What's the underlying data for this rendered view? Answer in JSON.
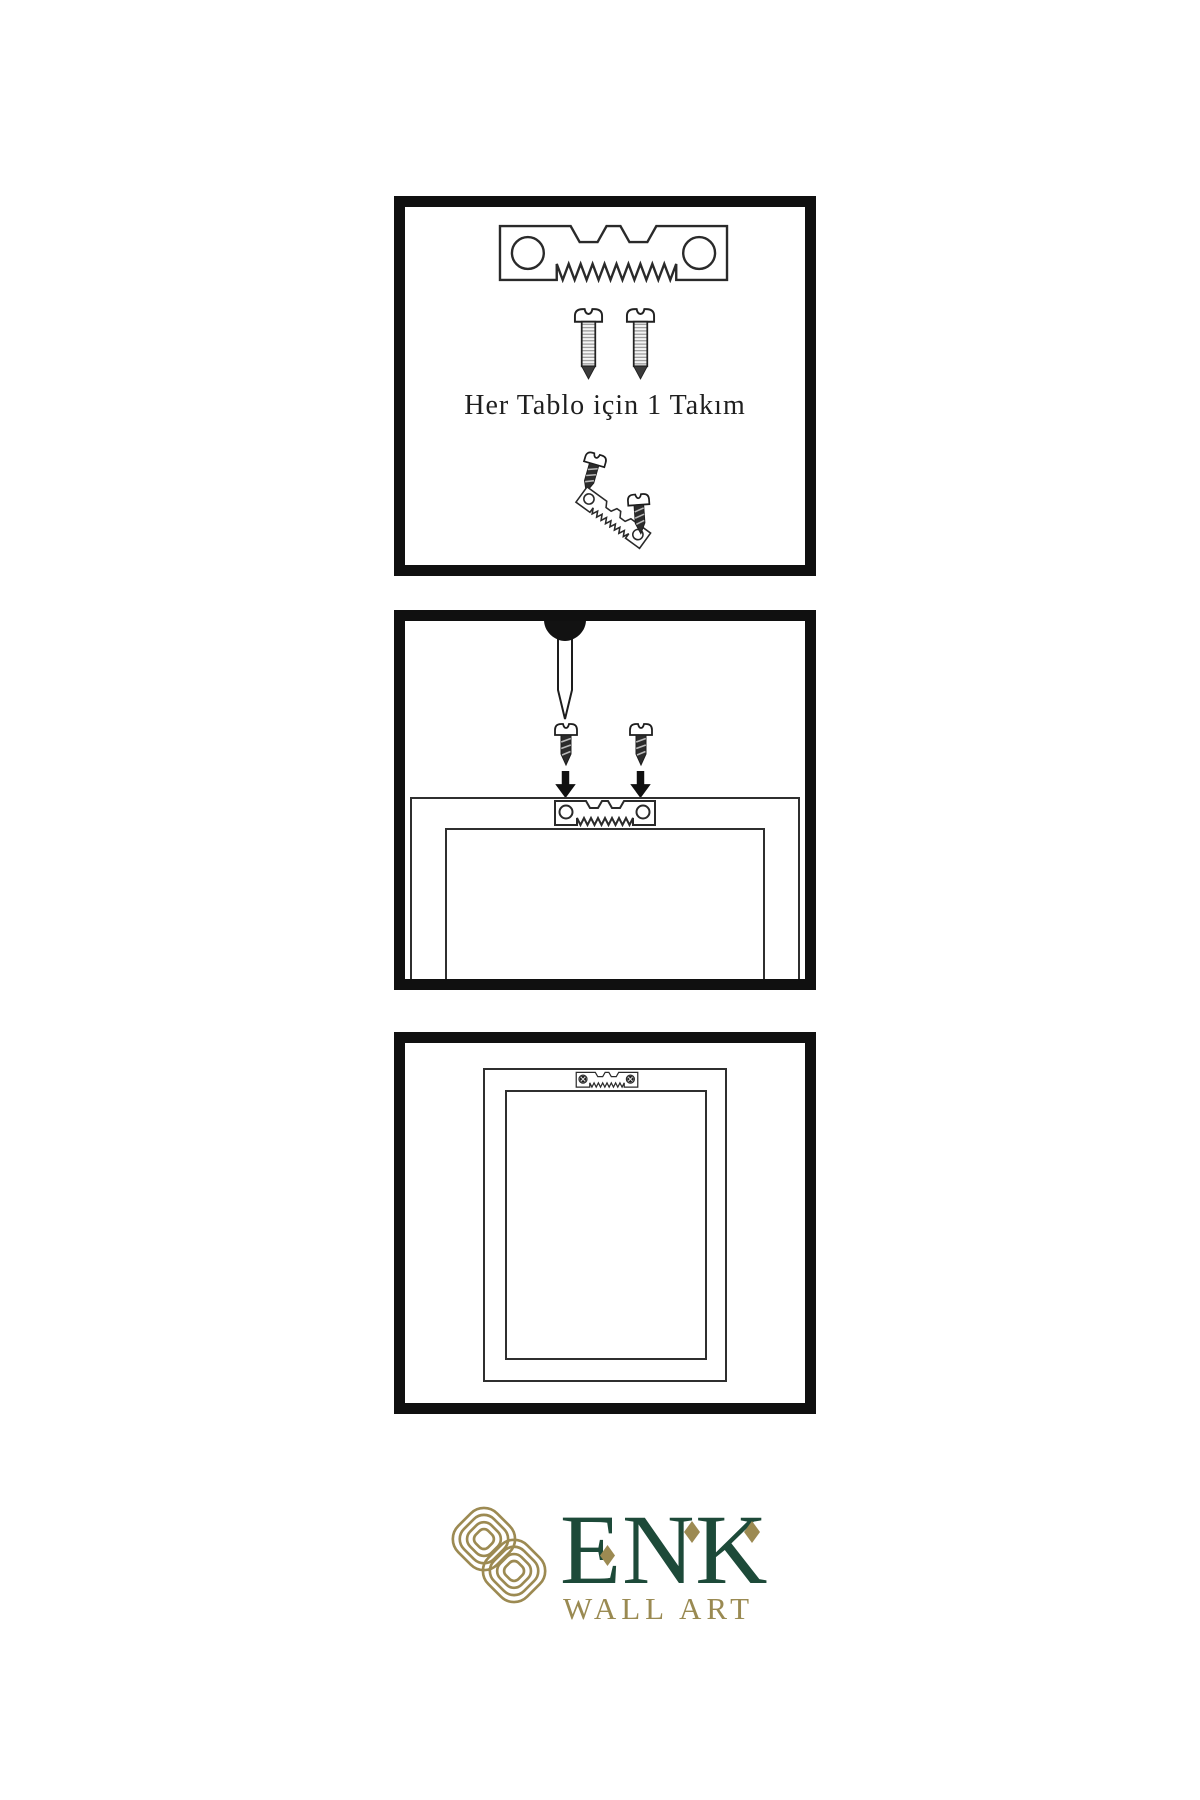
{
  "colors": {
    "background": "#ffffff",
    "panel_border": "#101010",
    "line_dark": "#2f2f2f",
    "metal_dark": "#2c2c2c",
    "logo_green": "#1d4a39",
    "logo_gold": "#9c8a52"
  },
  "panels": [
    {
      "caption": "Her Tablo için 1 Takım"
    },
    {},
    {}
  ],
  "icons": [
    "sawtooth-hanger-icon",
    "screw-icon",
    "nail-icon",
    "arrow-down-icon",
    "sawtooth-hanger-with-screws-icon",
    "knot-logo-icon"
  ],
  "logo": {
    "title": "ENK",
    "subtitle": "WALL ART"
  }
}
